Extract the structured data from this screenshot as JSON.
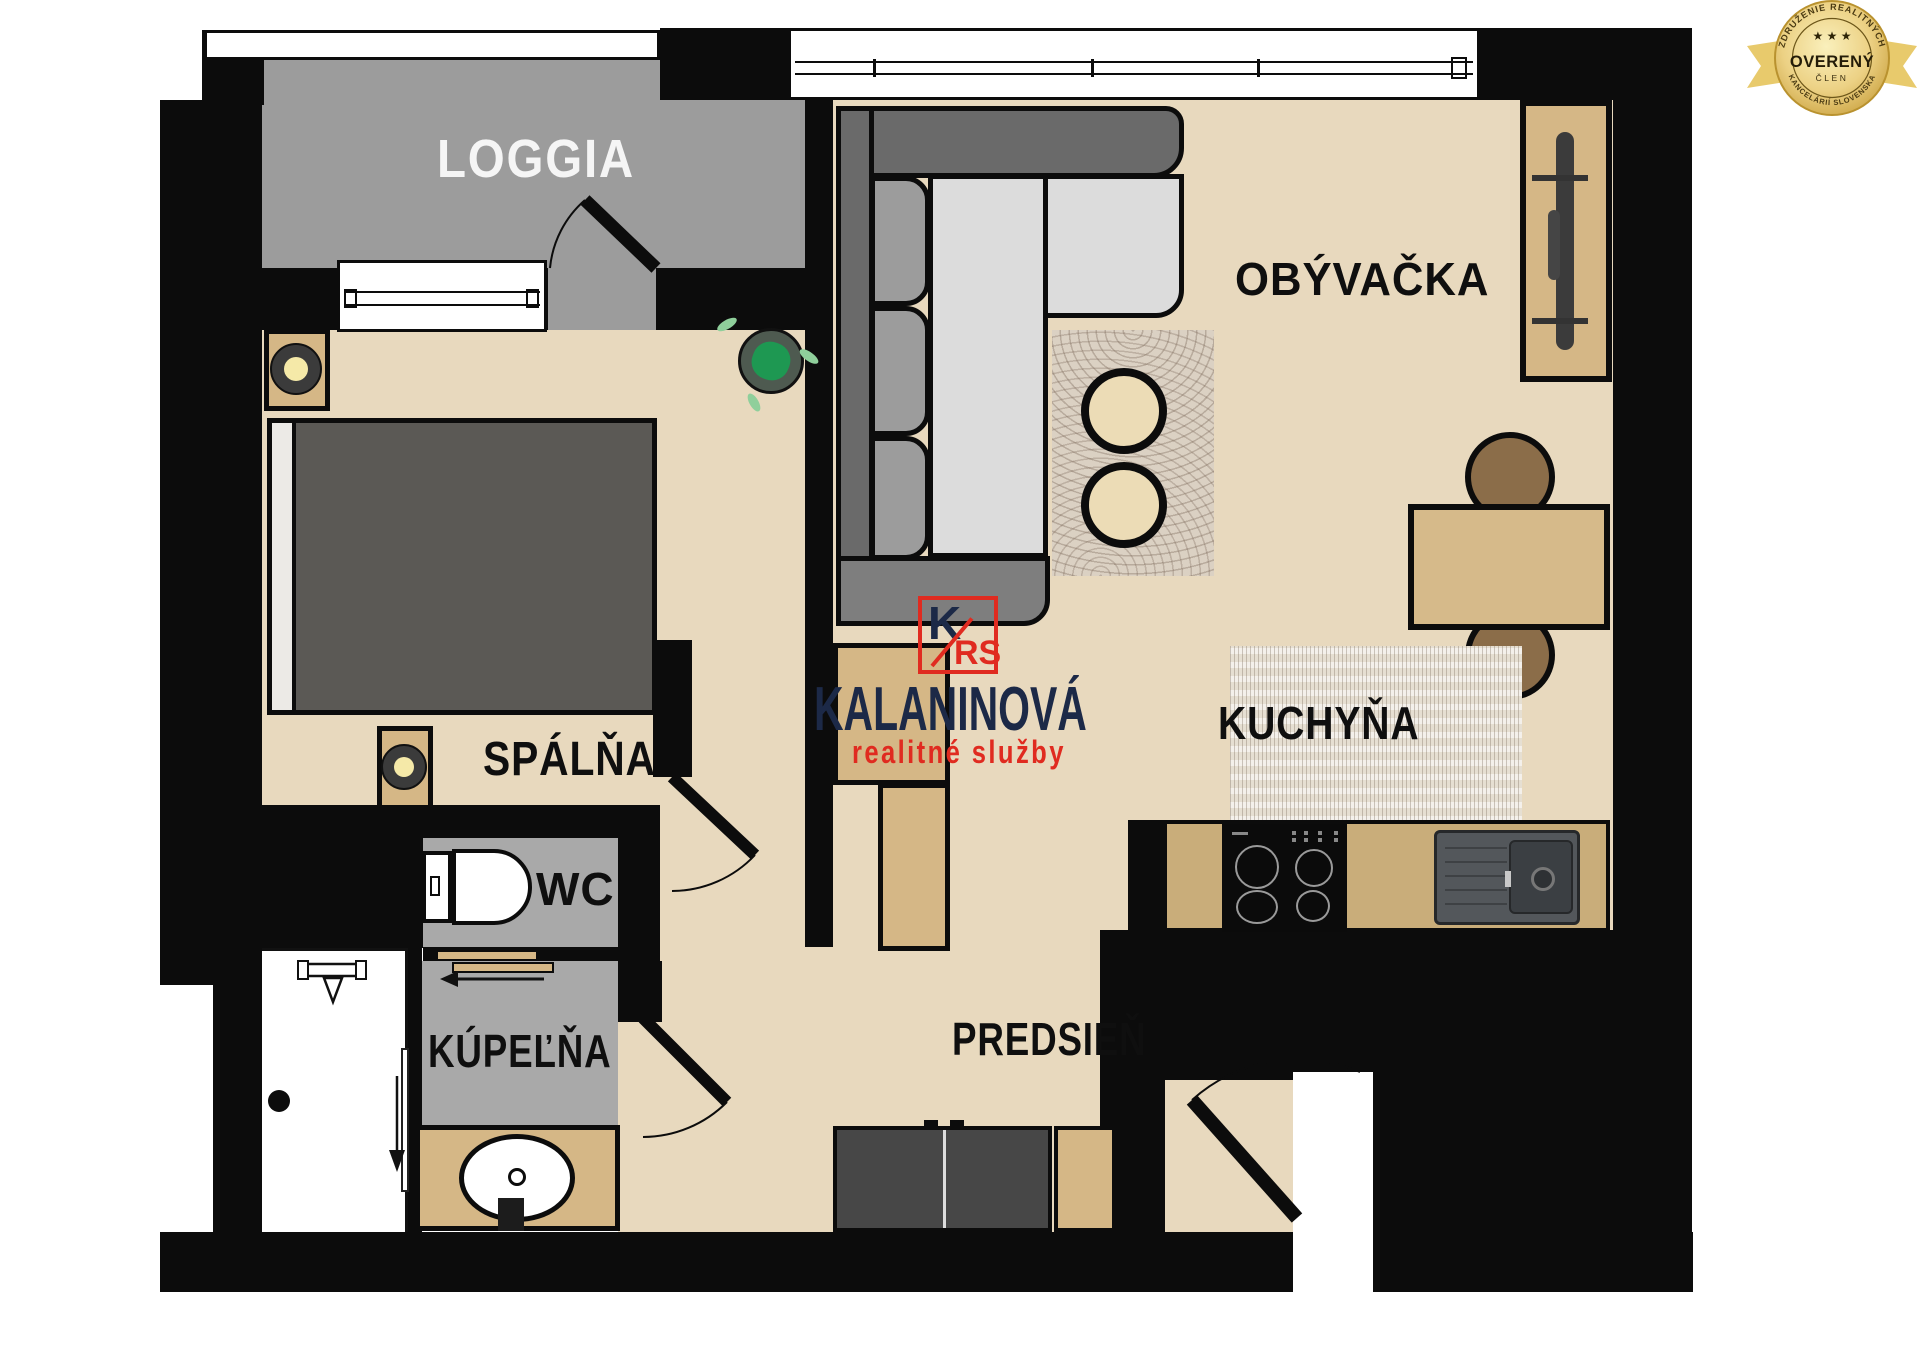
{
  "rooms": {
    "loggia": "LOGGIA",
    "living_room": "OBÝVAČKA",
    "bedroom": "SPÁLŇA",
    "wc": "WC",
    "bathroom": "KÚPEĽŇA",
    "hallway": "PREDSIEŇ",
    "kitchen": "KUCHYŇA"
  },
  "watermark": {
    "monogram_top": "K",
    "monogram_bottom": "RS",
    "brand": "KALANINOVÁ",
    "tagline": "realitné služby"
  },
  "badge": {
    "arc_top": "ZDRUŽENIE REALITNÝCH",
    "stars": "★ ★ ★",
    "title": "OVERENÝ",
    "subtitle": "ČLEN",
    "arc_bottom": "KANCELÁRIÍ SLOVENSKA"
  },
  "colors": {
    "wall": "#0c0c0c",
    "floor": "#e8d9be",
    "loggia_floor": "#9c9c9c",
    "wet_floor": "#a9a9a9",
    "wood": "#d5b786",
    "brand_red": "#e02b20",
    "brand_navy": "#1c2947",
    "badge_gold": "#e8ca6c"
  }
}
